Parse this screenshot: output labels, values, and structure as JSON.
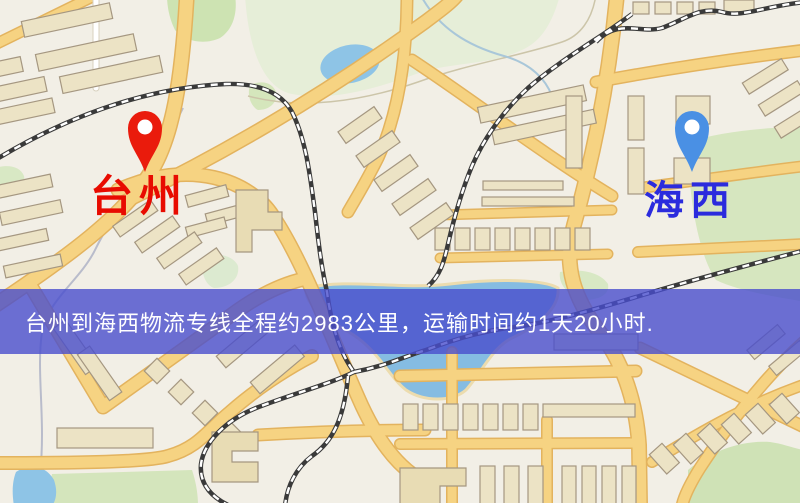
{
  "map": {
    "markers": {
      "origin": {
        "label": "台州",
        "label_color": "#e80b00",
        "pin_color": "#ea1b0c"
      },
      "destination": {
        "label": "海西",
        "label_color": "#2b2bdd",
        "pin_color": "#4a90e4"
      }
    },
    "banner": {
      "text": "台州到海西物流专线全程约2983公里，运输时间约1天20小时.",
      "distance_km": "2983",
      "duration": "1天20小时",
      "background": "rgba(72,78,205,0.80)",
      "text_color": "#ffffff"
    },
    "palette": {
      "background": "#f2efe6",
      "road_fill": "#f6d382",
      "road_casing": "#e3b35e",
      "water": "#8ec4e6",
      "green_area": "#d6e6bf",
      "building_fill": "#ece3c5",
      "building_stroke": "#a59781",
      "railway": "#3a3a3a"
    }
  }
}
